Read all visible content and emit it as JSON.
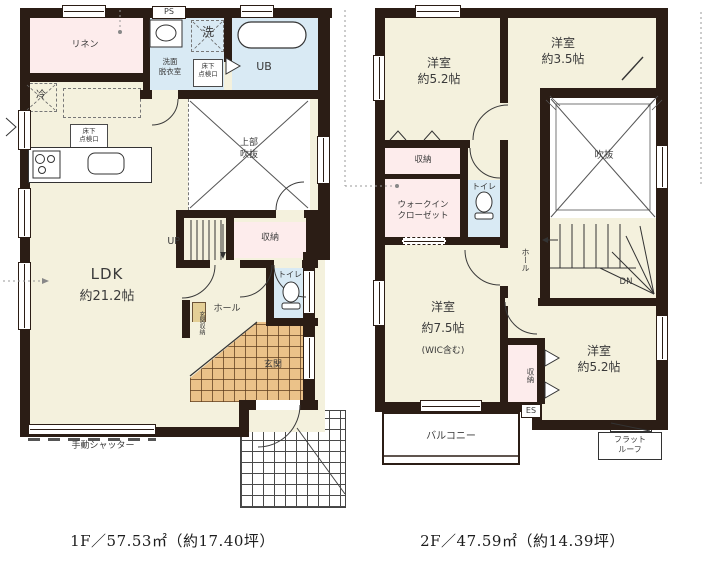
{
  "colors": {
    "wall": "#2b1d15",
    "floor": "#f4f1dd",
    "pink": "#fdecec",
    "blue": "#d9eaf4",
    "tile": "#ebc289",
    "tan": "#e4cf96"
  },
  "floor1": {
    "caption": "1F／57.53㎡（約17.40坪）",
    "labels": {
      "linen": "リネン",
      "fridge": "冷",
      "washer": "洗",
      "ps": "PS",
      "washroom1": "洗面",
      "washroom2": "脱衣室",
      "hatch1": "床下",
      "hatch2": "点検口",
      "ub": "UB",
      "void1": "上部",
      "void2": "吹抜",
      "up": "UP",
      "storage": "収納",
      "toilet": "トイレ",
      "hall": "ホール",
      "entry_storage": "玄関収納",
      "entry": "玄関",
      "ldk1": "LDK",
      "ldk2": "約21.2帖",
      "shutter": "手動シャッター"
    }
  },
  "floor2": {
    "caption": "2F／47.59㎡（約14.39坪）",
    "labels": {
      "room_a1": "洋室",
      "room_a2": "約5.2帖",
      "room_b1": "洋室",
      "room_b2": "約3.5帖",
      "storage_top": "収納",
      "wic1": "ウォークイン",
      "wic2": "クローゼット",
      "toilet": "トイレ",
      "void": "吹抜",
      "hall": "ホール",
      "dn": "DN",
      "room_c1": "洋室",
      "room_c2": "約7.5帖",
      "room_c3": "(WIC含む)",
      "storage_side": "収納",
      "room_d1": "洋室",
      "room_d2": "約5.2帖",
      "balcony": "バルコニー",
      "es": "ES",
      "flatroof1": "フラット",
      "flatroof2": "ルーフ"
    }
  }
}
